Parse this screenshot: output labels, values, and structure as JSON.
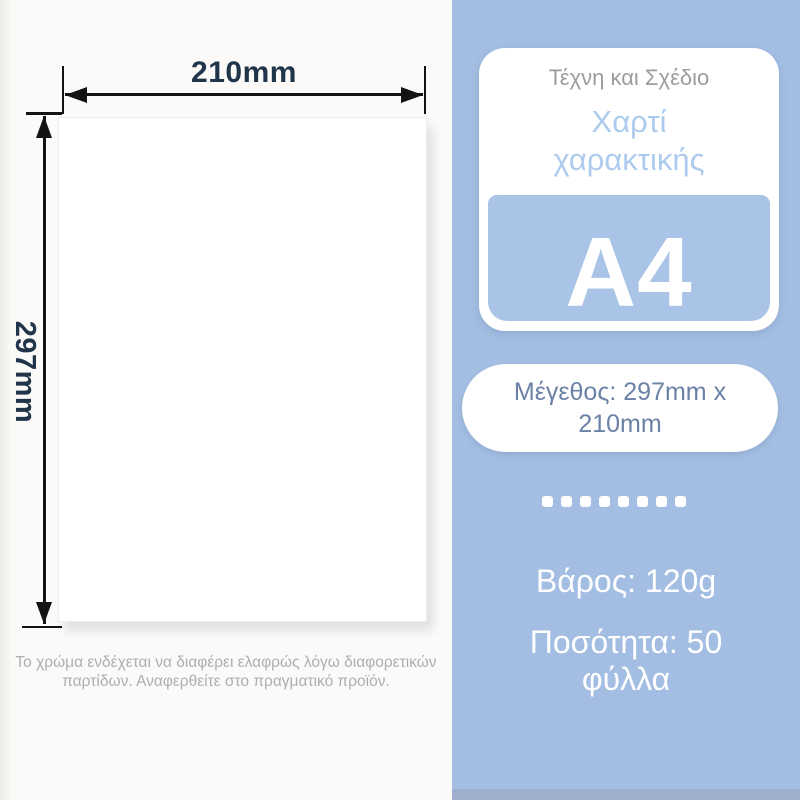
{
  "product_banner": {
    "dimensions": {
      "width_label": "210mm",
      "height_label": "297mm"
    },
    "disclaimer": "Το χρώμα ενδέχεται να διαφέρει ελαφρώς λόγω διαφορετικών παρτίδων. Αναφερθείτε στο πραγματικό προϊόν.",
    "card": {
      "category": "Τέχνη και Σχέδιο",
      "product_name": "Χαρτί χαρακτικής",
      "size_code": "A4"
    },
    "size_badge": "Μέγεθος: 297mm x 210mm",
    "separator_dots": 8,
    "weight": "Βάρος: 120g",
    "quantity": "Ποσότητα: 50 φύλλα",
    "colors": {
      "panel_blue": "#A3BEE2",
      "inner_blue": "#A9C4E6",
      "title_blue": "#ADCBEE",
      "pill_text_blue": "#6B81A6",
      "dimension_text": "#20344A",
      "subtitle_gray": "#9C9C9C",
      "disclaimer_gray": "#AEAEAE",
      "arrow_black": "#131313",
      "bottom_strip": "#9DAFCC"
    }
  }
}
